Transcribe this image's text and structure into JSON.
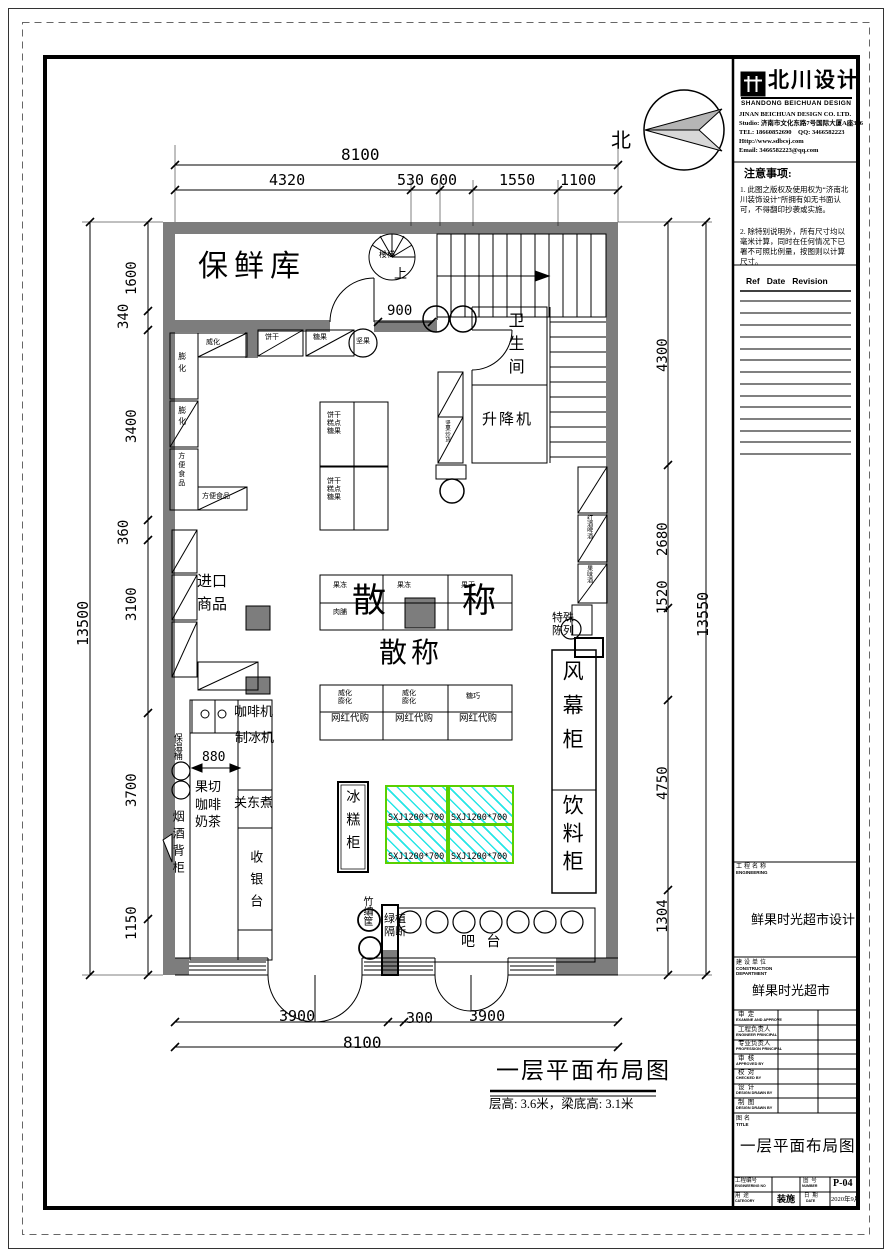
{
  "colors": {
    "wall": "#7d7d7d",
    "sxj_border": "#5ad000",
    "sxj_hatch": "#00e1e1",
    "paper": "#ffffff"
  },
  "title_block": {
    "logo": {
      "cn": "北川设计",
      "en": "SHANDONG BEICHUAN DESIGN"
    },
    "company_lines": [
      "JINAN BEICHUAN DESIGN CO. LTD.",
      "Studio: 济南市文化东路7号国际大厦A座306",
      "TEL: 18660852690    QQ: 3466582223",
      "Http://www.sdbcsj.com",
      "Email: 3466582223@qq.com"
    ],
    "notes": {
      "title": "注意事项:",
      "item1": "1. 此图之版权及使用权为“济南北川装饰设计”所拥有如无书面认可，不得翻印抄袭或实施。",
      "item2": "2. 除特别说明外，所有尺寸均以毫米计算，同时在任何情况下已署不可照比例量，按图则以计算尺寸。"
    },
    "revision": {
      "header": "Ref   Date   Revision"
    },
    "engineering": {
      "label_cn": "工程名称",
      "label_en": "ENGINEERING",
      "value": "鲜果时光超市设计"
    },
    "construction": {
      "label_cn": "建设单位",
      "label_en1": "CONSTRUCTION",
      "label_en2": "DEPARTMENT",
      "value": "鲜果时光超市"
    },
    "signatures": [
      {
        "cn": "审  定",
        "en": "EXAMINE AND APPROVE"
      },
      {
        "cn": "工程负责人",
        "en": "ENGINEER PRINCIPAL"
      },
      {
        "cn": "专业负责人",
        "en": "PROFESSION PRINCIPAL"
      },
      {
        "cn": "审  核",
        "en": "APPROVED BY"
      },
      {
        "cn": "校  对",
        "en": "CHECKED BY"
      },
      {
        "cn": "设  计",
        "en": "DESIGN DRAWN BY"
      },
      {
        "cn": "制  图",
        "en": "DESIGN DRAWN BY"
      }
    ],
    "drawing_title": {
      "label_cn": "图名",
      "label_en": "TITLE",
      "value": "一层平面布局图"
    },
    "footer": {
      "no_label_cn": "工程编号",
      "no_label_en": "ENGINEERING NO",
      "no_value": "",
      "num_label_cn": "图  号",
      "num_label_en": "NUMBER",
      "num_value": "P-04",
      "cat_label_cn": "用  途",
      "cat_label_en": "CATEGORY",
      "cat_value": "装施",
      "date_label_cn": "日  期",
      "date_label_en": "DATE",
      "date_value": "2020年9月"
    }
  },
  "plan": {
    "north": "北",
    "caption": {
      "title": "一层平面布局图",
      "subtitle": "层高: 3.6米，梁底高: 3.1米"
    },
    "rooms": {
      "fresh_store": "保鲜库",
      "stair_note": "楼梯",
      "stair_up": "上",
      "toilet": "卫生间",
      "lift": "升降机"
    },
    "shelves": {
      "weihua_top": "威化",
      "binggan_top": "饼干",
      "tangguo_top": "糖果",
      "jianguo_circle": "坚果",
      "penghua": "膨化",
      "fangbian": "方便食品",
      "imported": "进口商品",
      "center_unit": "饼干糕点糖果",
      "jelly": "果冻",
      "dried_fruit": "果干",
      "meat": "肉脯",
      "bulk_left": "散",
      "bulk_right": "称",
      "bulk_2": "散称",
      "wafer_puff": "威化膨化",
      "candy_choc": "糖巧",
      "wanghong": "网红代购",
      "wine_beer": "红酒啤酒",
      "fruit_wine": "果味酒",
      "special_display": "特殊陈列",
      "side_small": "坚果炒货"
    },
    "equipment": {
      "coffee_machine": "咖啡机",
      "ice_maker": "制冰机",
      "thermal_barrel": "保温桶",
      "fruit_cut": "果切咖啡奶茶",
      "oden": "关东煮",
      "cig_cabinet": "烟酒背柜",
      "cashier": "收银台",
      "ice_cream_cabinet": "冰糕柜",
      "sxj": "SXJ1200*700",
      "air_curtain": "风幕柜",
      "drink_cabinet": "饮料柜",
      "bamboo": "竹编筐",
      "plant_divider": "绿植隔断",
      "bar": "吧 台"
    },
    "dims": {
      "top_total": "8100",
      "top_1": "4320",
      "top_2": "530",
      "top_3": "600",
      "top_4": "1550",
      "top_5": "1100",
      "left_total": "13500",
      "left_1": "1600",
      "left_2": "340",
      "left_3": "3400",
      "left_4": "360",
      "left_5": "3100",
      "left_6": "3700",
      "left_7": "1150",
      "right_total": "13550",
      "right_1": "4300",
      "right_2": "2680",
      "right_3": "1520",
      "right_4": "4750",
      "right_5": "1304",
      "bottom_1": "3900",
      "bottom_2": "300",
      "bottom_3": "3900",
      "bottom_total": "8100",
      "stair": "900",
      "counter": "880"
    }
  }
}
